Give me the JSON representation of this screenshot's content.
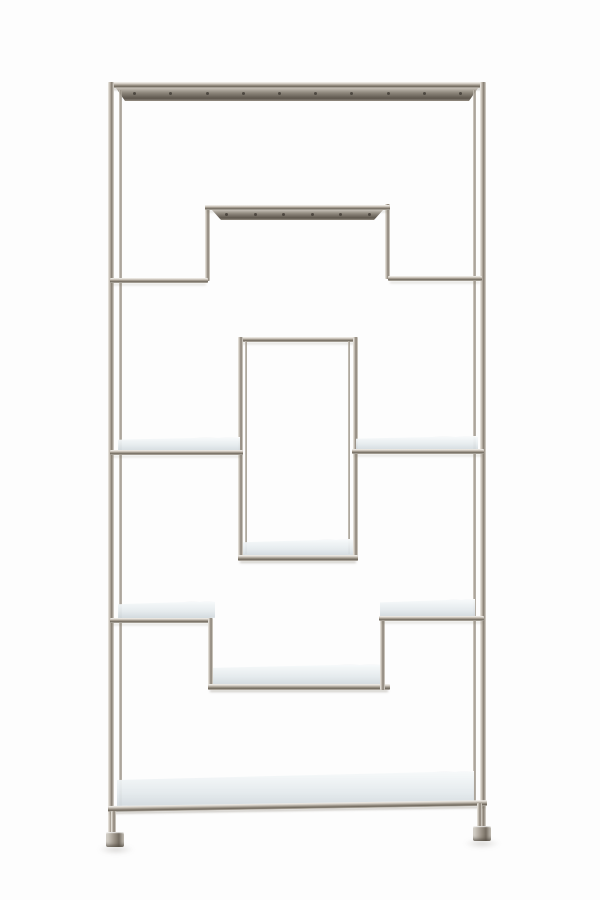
{
  "meta": {
    "description": "Silver chrome geometric etagere shelving unit with asymmetric tiers and mirrored glass shelves, product photo on white background",
    "subject": "chrome-etagere"
  },
  "palette": {
    "chrome_light": "#f0eeea",
    "chrome_mid": "#a89f93",
    "chrome_dark": "#6e675c",
    "flange_dark": "#5d564d",
    "glass_light": "#f3f6f7",
    "glass_mid": "#dde3e7",
    "glass_edge": "#9aa1a5",
    "rivet": "#3f3a33",
    "background": "#fdfdfd"
  },
  "scene": {
    "width": 600,
    "height": 900,
    "members": [
      {
        "name": "frame-top-bar",
        "type": "chrome-h",
        "x": 108,
        "y": 82,
        "w": 378,
        "h": 6
      },
      {
        "name": "frame-top-flange",
        "type": "flange",
        "x": 116,
        "y": 88,
        "w": 362,
        "h": 13,
        "rivets": 10
      },
      {
        "name": "frame-left-leg",
        "type": "chrome-v",
        "x": 108,
        "y": 82,
        "w": 6,
        "h": 754
      },
      {
        "name": "frame-left-leg-back",
        "type": "chrome-v-back",
        "x": 119,
        "y": 90,
        "w": 3,
        "h": 720
      },
      {
        "name": "frame-right-leg",
        "type": "chrome-v",
        "x": 480,
        "y": 82,
        "w": 6,
        "h": 748
      },
      {
        "name": "frame-right-leg-back",
        "type": "chrome-v-back",
        "x": 473,
        "y": 90,
        "w": 3,
        "h": 714
      },
      {
        "name": "bridge-left-post",
        "type": "chrome-v",
        "x": 205,
        "y": 205,
        "w": 5,
        "h": 76
      },
      {
        "name": "bridge-right-post",
        "type": "chrome-v",
        "x": 385,
        "y": 204,
        "w": 5,
        "h": 75
      },
      {
        "name": "bridge-top-bar",
        "type": "chrome-h",
        "x": 205,
        "y": 205,
        "w": 185,
        "h": 5
      },
      {
        "name": "bridge-flange",
        "type": "flange",
        "x": 212,
        "y": 210,
        "w": 171,
        "h": 10,
        "rivets": 6
      },
      {
        "name": "tier2-left-shelf-bar",
        "type": "chrome-h",
        "x": 110,
        "y": 278,
        "w": 98,
        "h": 5
      },
      {
        "name": "tier2-right-shelf-bar",
        "type": "chrome-h",
        "x": 388,
        "y": 276,
        "w": 94,
        "h": 5
      },
      {
        "name": "box-top-bar",
        "type": "chrome-h",
        "x": 238,
        "y": 337,
        "w": 120,
        "h": 5
      },
      {
        "name": "box-left-post",
        "type": "chrome-v",
        "x": 238,
        "y": 337,
        "w": 5,
        "h": 224
      },
      {
        "name": "box-left-post-back",
        "type": "chrome-v-back",
        "x": 245,
        "y": 341,
        "w": 2,
        "h": 213
      },
      {
        "name": "box-right-post",
        "type": "chrome-v",
        "x": 353,
        "y": 337,
        "w": 5,
        "h": 224
      },
      {
        "name": "box-right-post-back",
        "type": "chrome-v-back",
        "x": 348,
        "y": 341,
        "w": 2,
        "h": 213
      },
      {
        "name": "box-glass-shelf",
        "type": "glass",
        "x": 243,
        "y": 539,
        "w": 110,
        "h": 17
      },
      {
        "name": "box-bottom-bar",
        "type": "chrome-h",
        "x": 238,
        "y": 555,
        "w": 120,
        "h": 6
      },
      {
        "name": "tier3-left-glass",
        "type": "glass",
        "x": 118,
        "y": 437,
        "w": 122,
        "h": 14
      },
      {
        "name": "tier3-left-shelf-bar",
        "type": "chrome-h",
        "x": 110,
        "y": 450,
        "w": 133,
        "h": 5
      },
      {
        "name": "tier3-right-glass",
        "type": "glass",
        "x": 356,
        "y": 436,
        "w": 122,
        "h": 14
      },
      {
        "name": "tier3-right-shelf-bar",
        "type": "chrome-h",
        "x": 352,
        "y": 449,
        "w": 132,
        "h": 5
      },
      {
        "name": "tier4-left-glass",
        "type": "glass",
        "x": 118,
        "y": 601,
        "w": 97,
        "h": 17
      },
      {
        "name": "tier4-left-shelf-bar",
        "type": "chrome-h",
        "x": 110,
        "y": 618,
        "w": 103,
        "h": 5
      },
      {
        "name": "tier4-left-drop-post",
        "type": "chrome-v",
        "x": 208,
        "y": 618,
        "w": 5,
        "h": 72
      },
      {
        "name": "tier4-center-glass",
        "type": "glass",
        "x": 213,
        "y": 664,
        "w": 170,
        "h": 21
      },
      {
        "name": "tier4-center-shelf-bar",
        "type": "chrome-h",
        "x": 208,
        "y": 684,
        "w": 182,
        "h": 6
      },
      {
        "name": "tier4-right-drop-post",
        "type": "chrome-v",
        "x": 380,
        "y": 616,
        "w": 5,
        "h": 74
      },
      {
        "name": "tier4-right-glass",
        "type": "glass",
        "x": 380,
        "y": 599,
        "w": 95,
        "h": 18
      },
      {
        "name": "tier4-right-shelf-bar",
        "type": "chrome-h",
        "x": 379,
        "y": 616,
        "w": 105,
        "h": 5
      },
      {
        "name": "base-glass-shelf",
        "type": "glass",
        "x": 117,
        "y": 771,
        "w": 357,
        "h": 38,
        "clip": "polygon(0 22%, 100% 0, 100% 78%, 0 100%)"
      },
      {
        "name": "base-shelf-bar",
        "type": "chrome-h",
        "x": 108,
        "y": 806,
        "w": 379,
        "h": 6,
        "rot": -0.9
      },
      {
        "name": "left-foot-leg",
        "type": "chrome-v",
        "x": 111,
        "y": 811,
        "w": 5,
        "h": 24
      },
      {
        "name": "right-foot-leg",
        "type": "chrome-v",
        "x": 477,
        "y": 803,
        "w": 5,
        "h": 26
      },
      {
        "name": "left-foot",
        "type": "foot",
        "x": 106,
        "y": 832,
        "w": 18,
        "h": 15
      },
      {
        "name": "right-foot",
        "type": "foot",
        "x": 473,
        "y": 826,
        "w": 18,
        "h": 15
      },
      {
        "name": "left-foot-shadow",
        "type": "shadow",
        "x": 98,
        "y": 845,
        "w": 36,
        "h": 9
      },
      {
        "name": "right-foot-shadow",
        "type": "shadow",
        "x": 464,
        "y": 839,
        "w": 36,
        "h": 9
      }
    ]
  }
}
